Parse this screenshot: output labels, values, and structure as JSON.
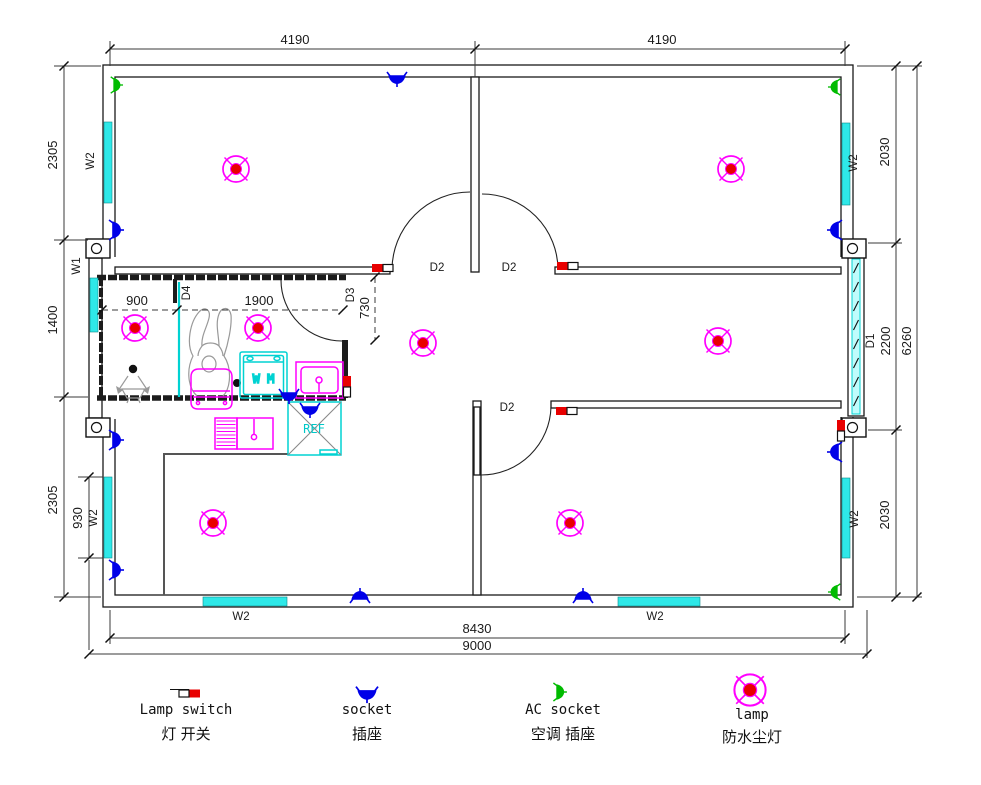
{
  "dims": {
    "top": [
      "4190",
      "4190"
    ],
    "left": [
      "2305",
      "1400",
      "2305"
    ],
    "left_window": "930",
    "right": [
      "2030",
      "2200",
      "2030"
    ],
    "right_total": "6260",
    "bottom_inner": "8430",
    "bottom_outer": "9000",
    "shower_width": "900",
    "bath_width": "1900",
    "door_clear": "730"
  },
  "marks": {
    "w1": "W1",
    "w2": "W2",
    "d1": "D1",
    "d2": "D2",
    "d3": "D3",
    "d4": "D4",
    "washer": "W M",
    "fridge": "REF"
  },
  "legend": {
    "items": [
      {
        "en": "Lamp switch",
        "zh": "灯 开关"
      },
      {
        "en": "socket",
        "zh": "插座"
      },
      {
        "en": "AC socket",
        "zh": "空调 插座"
      },
      {
        "en": "lamp",
        "zh": "防水尘灯"
      }
    ]
  },
  "colors": {
    "wall": "#1a1a1a",
    "window": "#2ee8e8",
    "lamp_ring": "#ff00ff",
    "lamp_center": "#e80000",
    "socket": "#0000e8",
    "ac_socket": "#00bb00",
    "switch": "#e80000",
    "fixture": "#ff00ff",
    "appliance": "#00d2d2"
  }
}
